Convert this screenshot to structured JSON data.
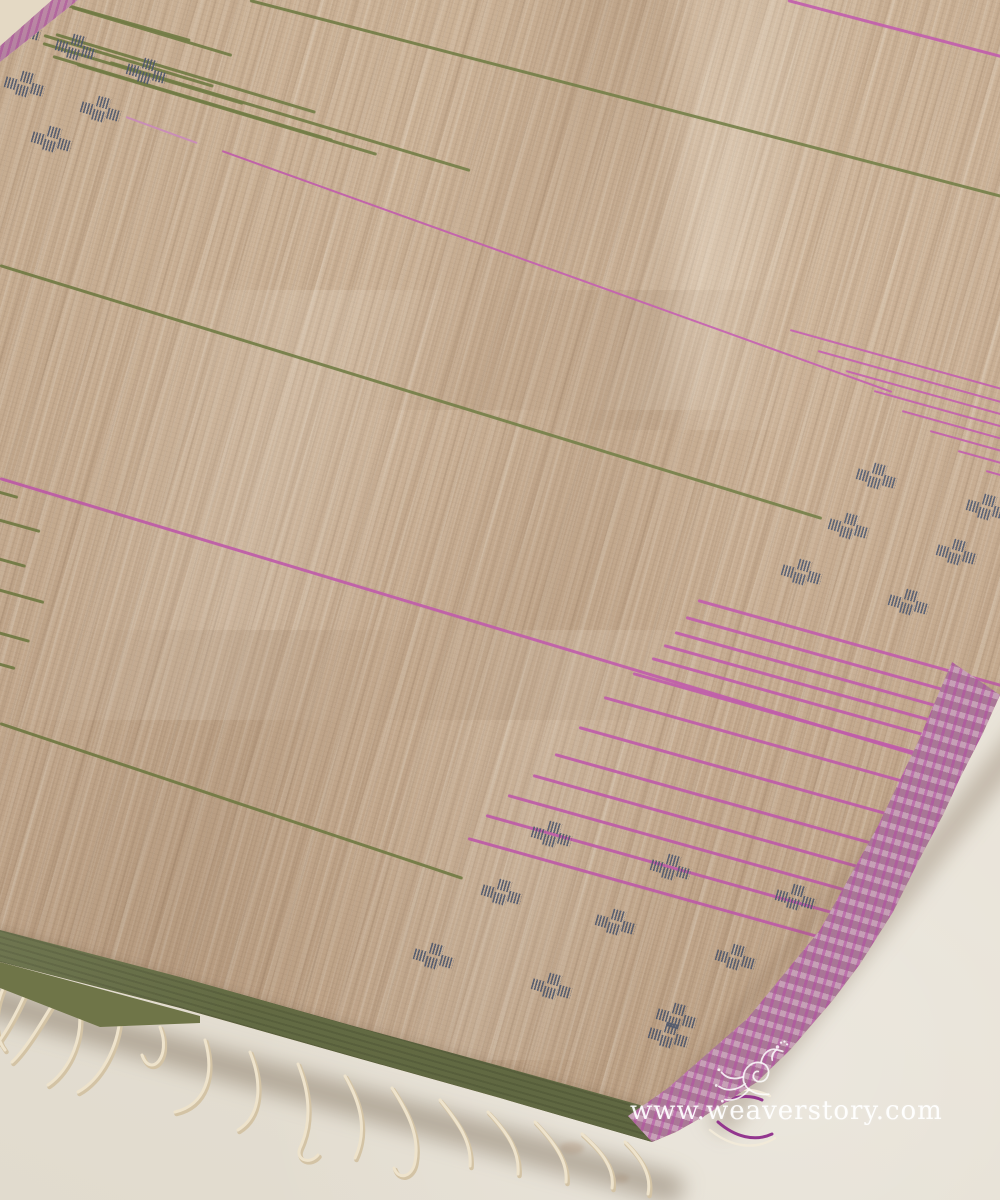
{
  "image": {
    "type": "product-photograph",
    "subject": "Beige handwoven tussar silk saree with pink and green stripes laid flat on an off-white surface, fringe tassels at lower left, pink striped selvedge at right, green border at bottom"
  },
  "watermark": {
    "text": "www.weaverstory.com",
    "logo": "weaverstory-peacock-flourish"
  },
  "colors": {
    "surface": "#e7e1d5",
    "fabric_base": "#c9ae92",
    "green_stripe": "#6e7b40",
    "pink_stripe": "#c257ae",
    "pink_faint": "#cf8cc0",
    "motif_blue": "#44526d",
    "border_green": "#737a4c",
    "border_pink": "#bd8ba8",
    "border_pink_stripe": "#b44ba4",
    "tassel_cream": "#eee3cc",
    "tassel_shadow": "#d3c3a5",
    "corner_thread_purple": "#93368f",
    "corner_thread_white": "#f2ead9"
  },
  "pattern": {
    "stripes": [
      [
        250,
        0,
        1002,
        196,
        2.5,
        "g"
      ],
      [
        0,
        265,
        822,
        518,
        2.5,
        "g"
      ],
      [
        0,
        723,
        463,
        878,
        2.5,
        "g"
      ],
      [
        50,
        0,
        190,
        40,
        2.5,
        "g"
      ],
      [
        72,
        7,
        232,
        55,
        2.5,
        "g"
      ],
      [
        44,
        35,
        214,
        86,
        2.5,
        "g"
      ],
      [
        43,
        43,
        243,
        103,
        2.5,
        "g"
      ],
      [
        56,
        34,
        316,
        112,
        2.5,
        "g"
      ],
      [
        53,
        56,
        333,
        140,
        2.5,
        "g"
      ],
      [
        77,
        64,
        377,
        154,
        2.5,
        "g"
      ],
      [
        110,
        62,
        470,
        170,
        2.5,
        "g"
      ],
      [
        -60,
        475,
        18,
        497,
        2.5,
        "g"
      ],
      [
        -60,
        503,
        40,
        531,
        2.5,
        "g"
      ],
      [
        -60,
        542,
        26,
        566,
        2.5,
        "g"
      ],
      [
        -60,
        573,
        44,
        602,
        2.5,
        "g"
      ],
      [
        -60,
        616,
        30,
        641,
        2.5,
        "g"
      ],
      [
        -60,
        647,
        15,
        668,
        2.5,
        "g"
      ],
      [
        788,
        0,
        1005,
        57,
        2.5,
        "p"
      ],
      [
        126,
        117,
        197,
        143,
        1.8,
        "pf"
      ],
      [
        222,
        151,
        892,
        392,
        2.2,
        "p"
      ],
      [
        0,
        478,
        975,
        772,
        2.6,
        "p"
      ],
      [
        698,
        600,
        1258,
        757,
        2.8,
        "p"
      ],
      [
        686,
        617,
        1246,
        774,
        2.8,
        "p"
      ],
      [
        675,
        632,
        1235,
        789,
        2.8,
        "p"
      ],
      [
        664,
        645,
        1224,
        802,
        2.8,
        "p"
      ],
      [
        652,
        658,
        1212,
        815,
        2.8,
        "p"
      ],
      [
        633,
        673,
        1193,
        830,
        2.8,
        "p"
      ],
      [
        604,
        697,
        1164,
        854,
        2.8,
        "p"
      ],
      [
        579,
        727,
        1139,
        884,
        2.8,
        "p"
      ],
      [
        555,
        754,
        1115,
        911,
        2.8,
        "p"
      ],
      [
        533,
        775,
        1093,
        932,
        2.8,
        "p"
      ],
      [
        508,
        795,
        1068,
        952,
        2.8,
        "p"
      ],
      [
        486,
        815,
        1046,
        972,
        2.8,
        "p"
      ],
      [
        468,
        838,
        1028,
        995,
        2.8,
        "p"
      ],
      [
        790,
        330,
        1210,
        447,
        2.2,
        "p"
      ],
      [
        818,
        351,
        1238,
        468,
        2.2,
        "p"
      ],
      [
        846,
        371,
        1266,
        488,
        2.2,
        "p"
      ],
      [
        874,
        391,
        1294,
        508,
        2.2,
        "p"
      ],
      [
        902,
        411,
        1322,
        528,
        2.2,
        "p"
      ],
      [
        930,
        431,
        1350,
        548,
        2.2,
        "p"
      ],
      [
        958,
        451,
        1378,
        568,
        2.2,
        "p"
      ],
      [
        986,
        471,
        1406,
        588,
        2.2,
        "p"
      ]
    ],
    "motifs": [
      [
        22,
        29
      ],
      [
        77,
        48
      ],
      [
        148,
        72
      ],
      [
        26,
        85
      ],
      [
        102,
        110
      ],
      [
        53,
        140
      ],
      [
        878,
        477
      ],
      [
        850,
        527
      ],
      [
        988,
        508
      ],
      [
        958,
        553
      ],
      [
        803,
        573
      ],
      [
        910,
        603
      ],
      [
        553,
        835
      ],
      [
        672,
        868
      ],
      [
        503,
        893
      ],
      [
        617,
        923
      ],
      [
        797,
        898
      ],
      [
        737,
        958
      ],
      [
        435,
        957
      ],
      [
        553,
        987
      ],
      [
        678,
        1017
      ],
      [
        670,
        1036
      ]
    ],
    "motif_square_offsets": [
      [
        14,
        -3
      ],
      [
        0,
        7
      ],
      [
        13,
        11
      ],
      [
        27,
        6
      ]
    ]
  },
  "tassels": {
    "strands": [
      "M10,975 C-5,1000 -10,1030 5,1050",
      "M30,982 C18,1012 2,1040 -10,1052",
      "M55,1000 C40,1025 25,1050 12,1062",
      "M78,1004 C85,1035 70,1070 48,1085",
      "M120,1016 C118,1048 100,1080 78,1092",
      "M160,1027 C172,1058 150,1078 142,1055",
      "M205,1040 C215,1075 205,1105 175,1112",
      "M250,1052 C262,1082 262,1115 238,1130",
      "M298,1064 C310,1094 312,1122 300,1148 C295,1160 310,1165 318,1155",
      "M345,1076 C360,1102 368,1130 355,1158",
      "M392,1088 C408,1112 420,1137 415,1162 C412,1178 398,1180 394,1168",
      "M440,1100 C458,1122 472,1142 470,1166",
      "M488,1112 C505,1130 520,1150 518,1174",
      "M535,1122 C552,1140 568,1160 566,1182",
      "M582,1134 C600,1150 615,1167 612,1188",
      "M625,1142 C640,1157 652,1174 648,1194"
    ],
    "corner_tie": {
      "purple": [
        "M700,1118 C720,1098 745,1092 762,1100",
        "M718,1122 C735,1137 755,1142 772,1134"
      ],
      "white": [
        "M695,1105 C720,1088 748,1085 770,1096",
        "M710,1130 C732,1148 756,1150 775,1138"
      ]
    }
  },
  "stains": [
    [
      500,
      1058,
      14
    ],
    [
      538,
      1098,
      10
    ],
    [
      572,
      1148,
      12
    ],
    [
      620,
      1178,
      9
    ],
    [
      476,
      1032,
      8
    ],
    [
      660,
      1102,
      7
    ]
  ]
}
